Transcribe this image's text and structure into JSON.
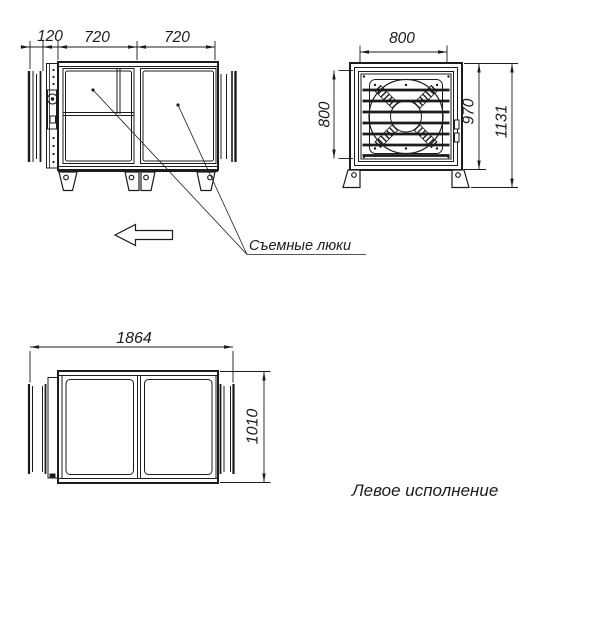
{
  "colors": {
    "line": "#1c1c1c",
    "background": "#ffffff"
  },
  "side_view": {
    "dim_duct_length": "120",
    "dim_section_left": "720",
    "dim_section_right": "720",
    "note_hatches": "Съемные люки"
  },
  "front_view": {
    "dim_opening_width": "800",
    "dim_opening_height": "800",
    "dim_body_height": "970",
    "dim_total_height": "1131"
  },
  "plan_view": {
    "dim_total_length": "1864",
    "dim_body_width": "1010"
  },
  "caption": "Левое исполнение",
  "icons": {
    "flow_arrow": "arrow-left-outline"
  }
}
